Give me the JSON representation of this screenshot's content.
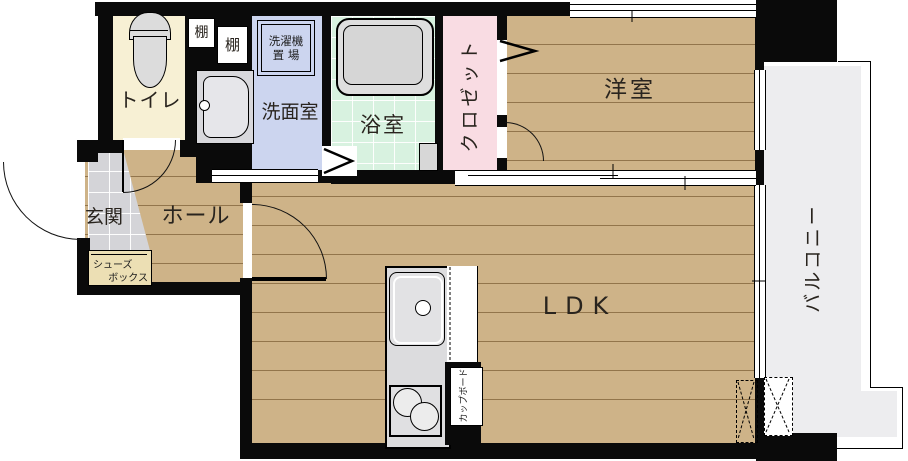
{
  "floorplan": {
    "rooms": {
      "toilet": {
        "label": "トイレ",
        "color": "#f7f0d4"
      },
      "washroom": {
        "label": "洗面室",
        "color": "#ccd5ef"
      },
      "bathroom": {
        "label": "浴室",
        "color": "#d8f2e0"
      },
      "closet": {
        "label": "クロゼット",
        "color": "#f9dce3"
      },
      "western_room": {
        "label": "洋室",
        "color": "#ceb388"
      },
      "entrance": {
        "label": "玄関",
        "color": "#d4d4d8"
      },
      "hall": {
        "label": "ホール",
        "color": "#ceb388"
      },
      "ldk": {
        "label": "LDK",
        "color": "#ceb388"
      },
      "balcony": {
        "label": "バルコニー",
        "color": "#ededef"
      }
    },
    "fixtures": {
      "shelf_1": {
        "label": "棚"
      },
      "shelf_2": {
        "label": "棚"
      },
      "washing_machine_area": {
        "line1": "洗濯機",
        "line2": "置 場"
      },
      "shoes_box": {
        "line1": "シューズ",
        "line2": "ボックス"
      },
      "cupboard": {
        "label": "カップボード"
      }
    },
    "wall_color": "#0a0a0a"
  }
}
